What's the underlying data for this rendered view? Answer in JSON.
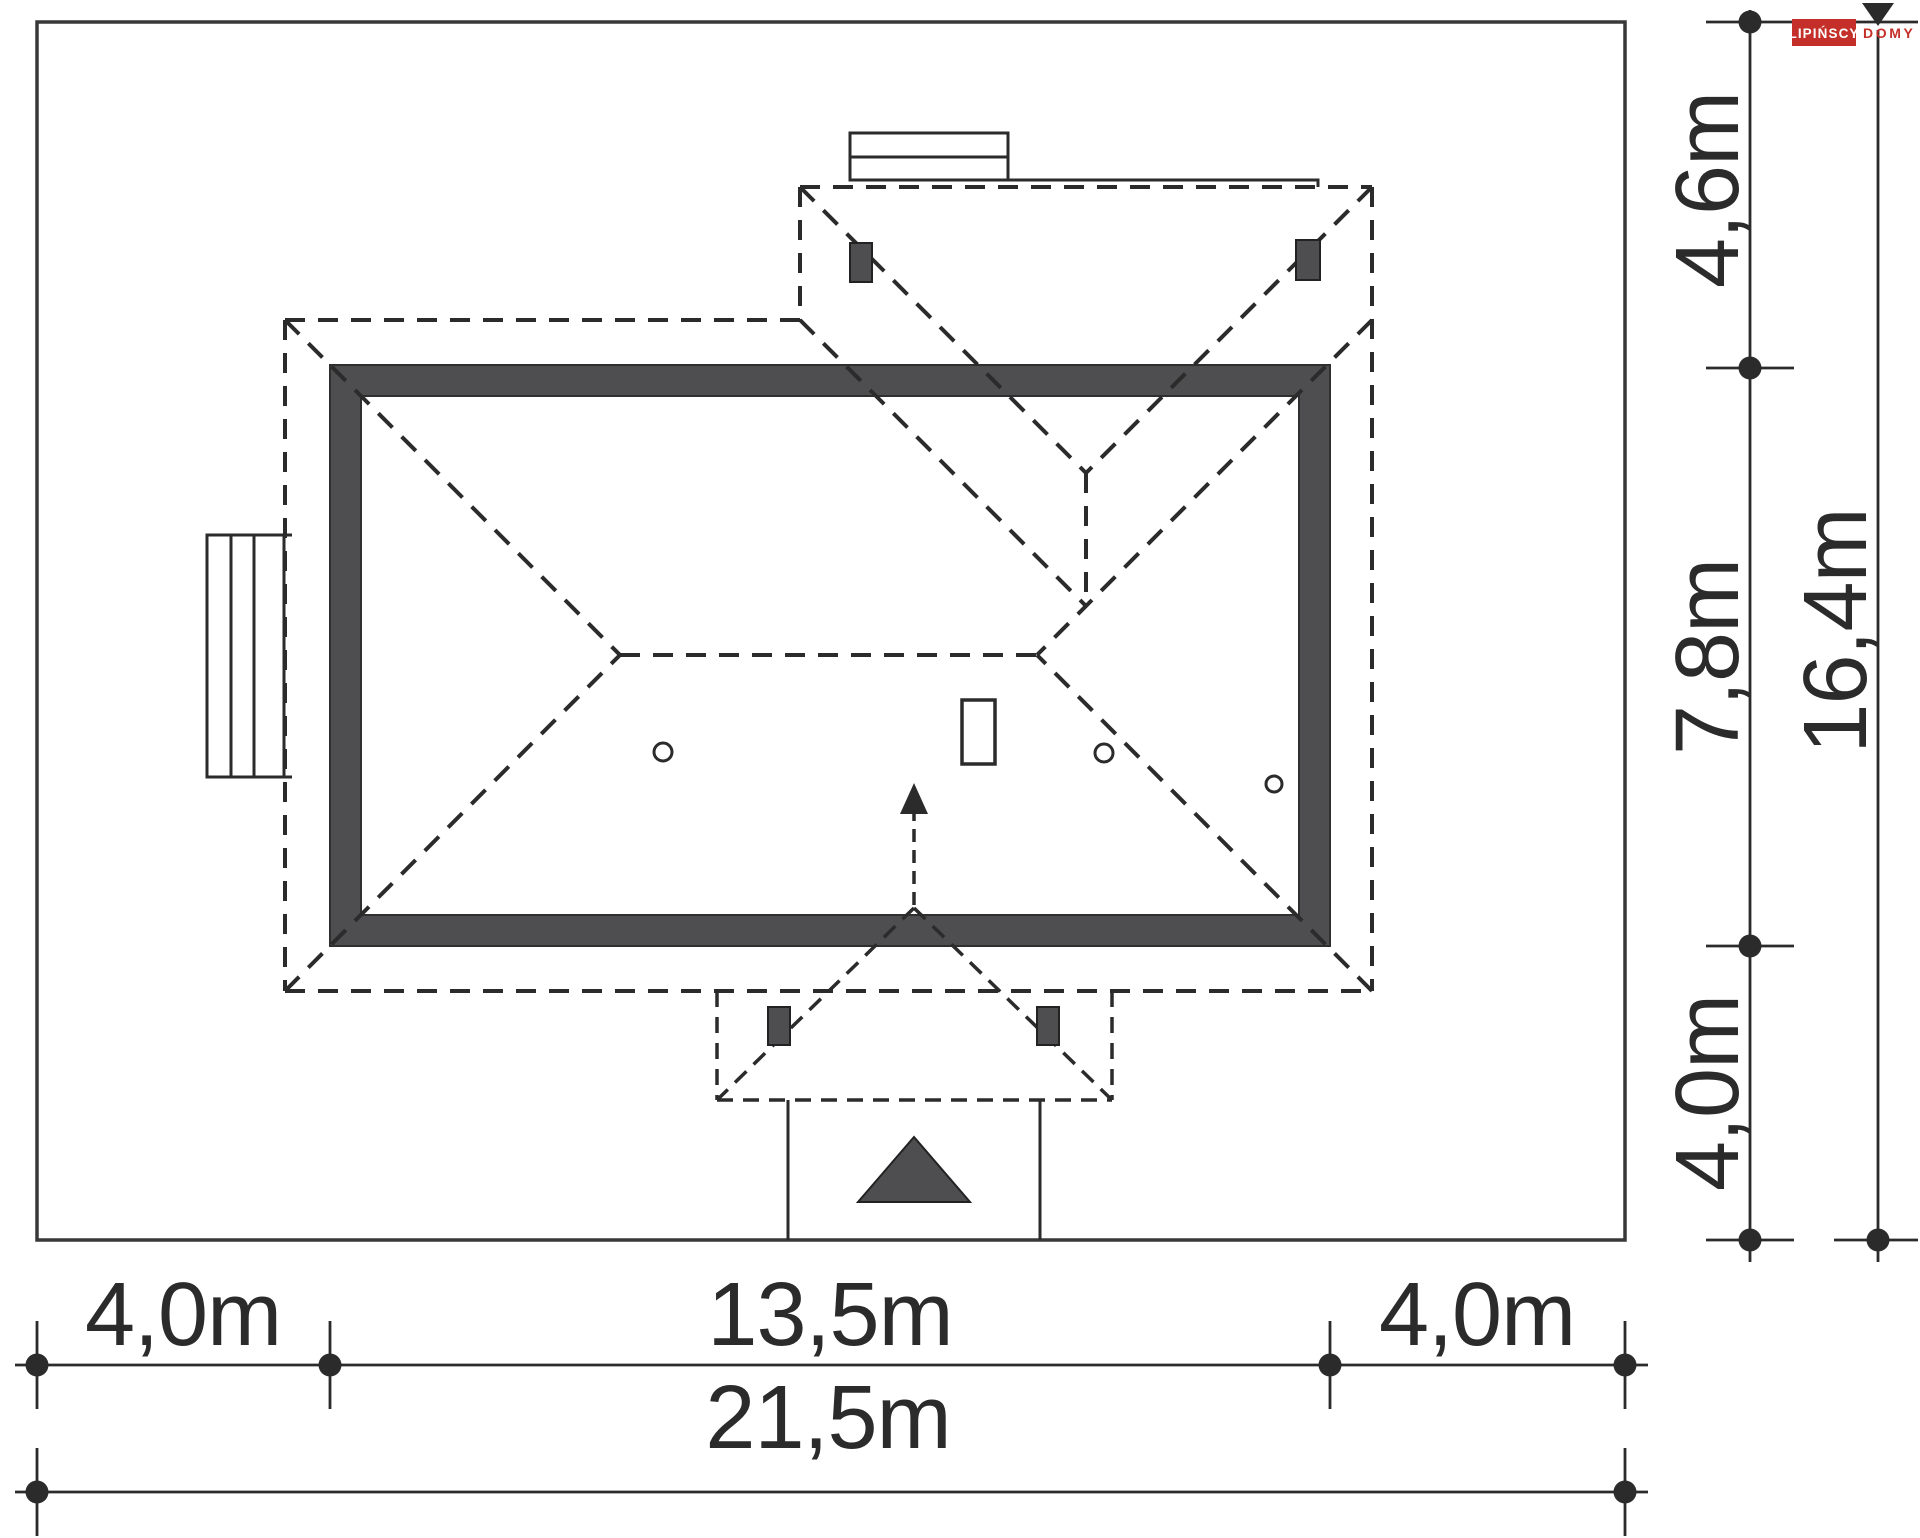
{
  "drawing": {
    "type": "house-site-plan-roof-view",
    "plot_size_m": {
      "width": "21,5",
      "depth": "16,4"
    },
    "house_footprint_m": {
      "width": "13,5",
      "depth": "7,8"
    }
  },
  "dimensions": {
    "right_segments": [
      {
        "label": "4,6m"
      },
      {
        "label": "7,8m"
      },
      {
        "label": "4,0m"
      }
    ],
    "right_total": {
      "label": "16,4m"
    },
    "bottom_segments": [
      {
        "label": "4,0m"
      },
      {
        "label": "13,5m"
      },
      {
        "label": "4,0m"
      }
    ],
    "bottom_total": {
      "label": "21,5m"
    }
  },
  "logo": {
    "brand": "LIPIŃSCY",
    "suffix": "DOMY"
  },
  "colors": {
    "line": "#2b2b2b",
    "wall": "#4e4e50",
    "red": "#c43029",
    "bg": "#ffffff"
  }
}
